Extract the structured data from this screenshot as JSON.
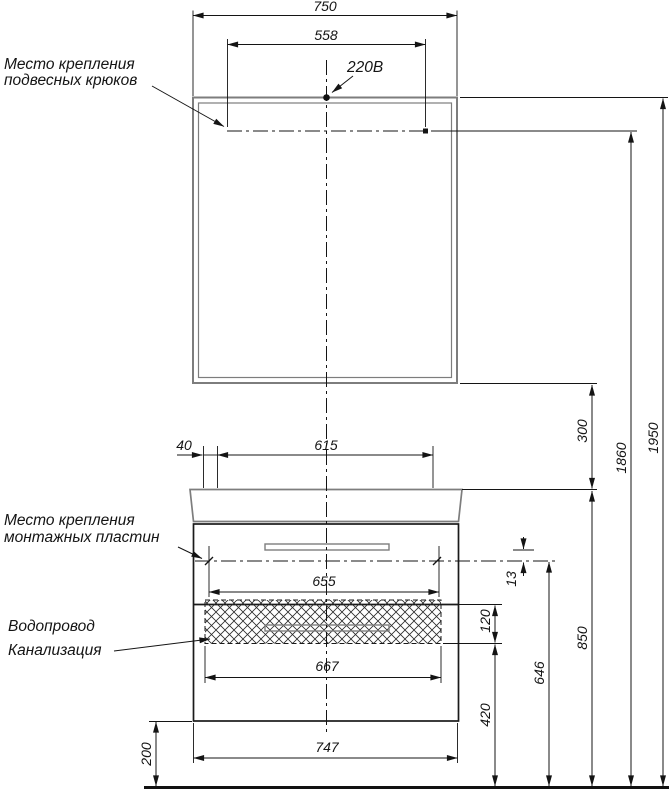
{
  "labels": {
    "hanging_hooks": {
      "line1": "Место крепления",
      "line2": "подвесных крюков"
    },
    "power": "220В",
    "mounting_plates": {
      "line1": "Место крепления",
      "line2": "монтажных пластин"
    },
    "utilities": {
      "line1": "Водопровод",
      "line2": "Канализация"
    }
  },
  "dimensions": {
    "top_width": "750",
    "hook_span": "558",
    "plate_left_offset": "40",
    "plate_top_span": "615",
    "mirror_gap": "300",
    "hook_height": "1860",
    "total_height": "1950",
    "plate_span": "655",
    "plate_edge_offset": "13",
    "pipe_zone_height": "120",
    "pipe_zone_width": "667",
    "plate_height": "646",
    "worktop_height": "850",
    "pipe_zone_bottom": "420",
    "cabinet_width": "747",
    "clearance_height": "200"
  }
}
